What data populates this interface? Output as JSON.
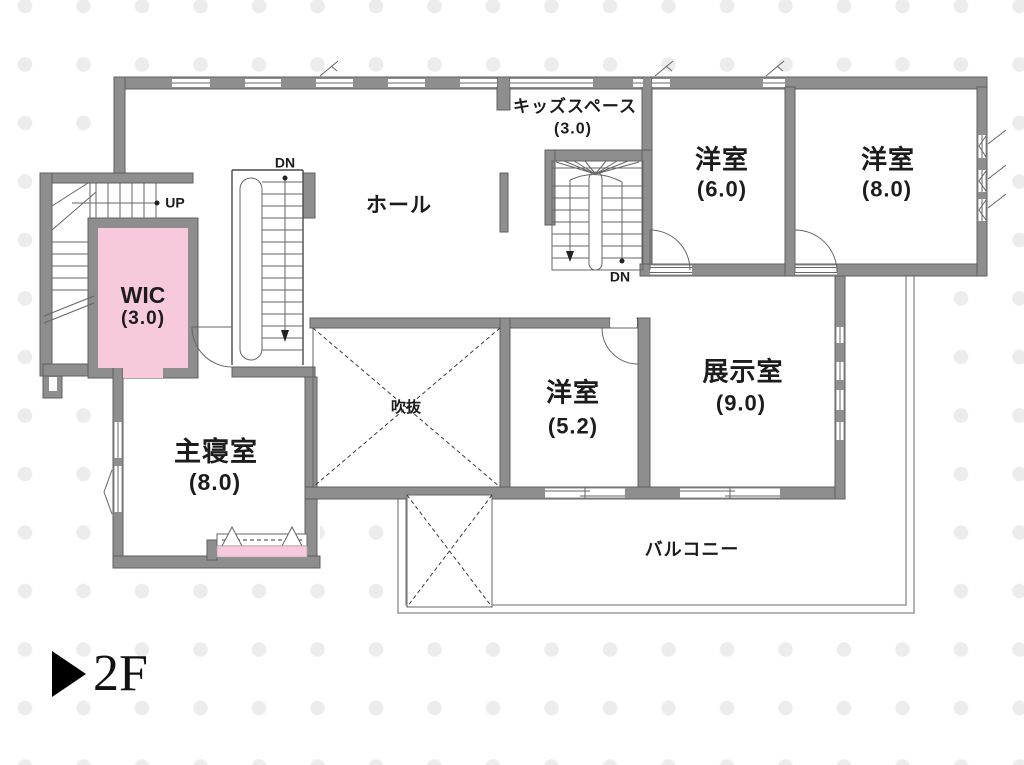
{
  "colors": {
    "wall": "#8e8e8e",
    "wall-edge": "#5f5f5f",
    "accent-pink": "#f7c9dd",
    "line": "#666666",
    "dot": "#ececec"
  },
  "floor_marker": {
    "label": "2F"
  },
  "rooms": {
    "hall": {
      "name": "ホール"
    },
    "kids_space": {
      "name": "キッズスペース",
      "size": "(3.0)"
    },
    "bedroom_6": {
      "name": "洋室",
      "size": "(6.0)"
    },
    "bedroom_8": {
      "name": "洋室",
      "size": "(8.0)"
    },
    "wic": {
      "name": "WIC",
      "size": "(3.0)"
    },
    "master_bedroom": {
      "name": "主寝室",
      "size": "(8.0)"
    },
    "void": {
      "name": "吹抜"
    },
    "bedroom_52": {
      "name": "洋室",
      "size": "(5.2)"
    },
    "exhibition": {
      "name": "展示室",
      "size": "(9.0)"
    },
    "balcony": {
      "name": "バルコニー"
    }
  },
  "stairs": {
    "up_label": "UP",
    "down_label_left": "DN",
    "down_label_center": "DN"
  }
}
